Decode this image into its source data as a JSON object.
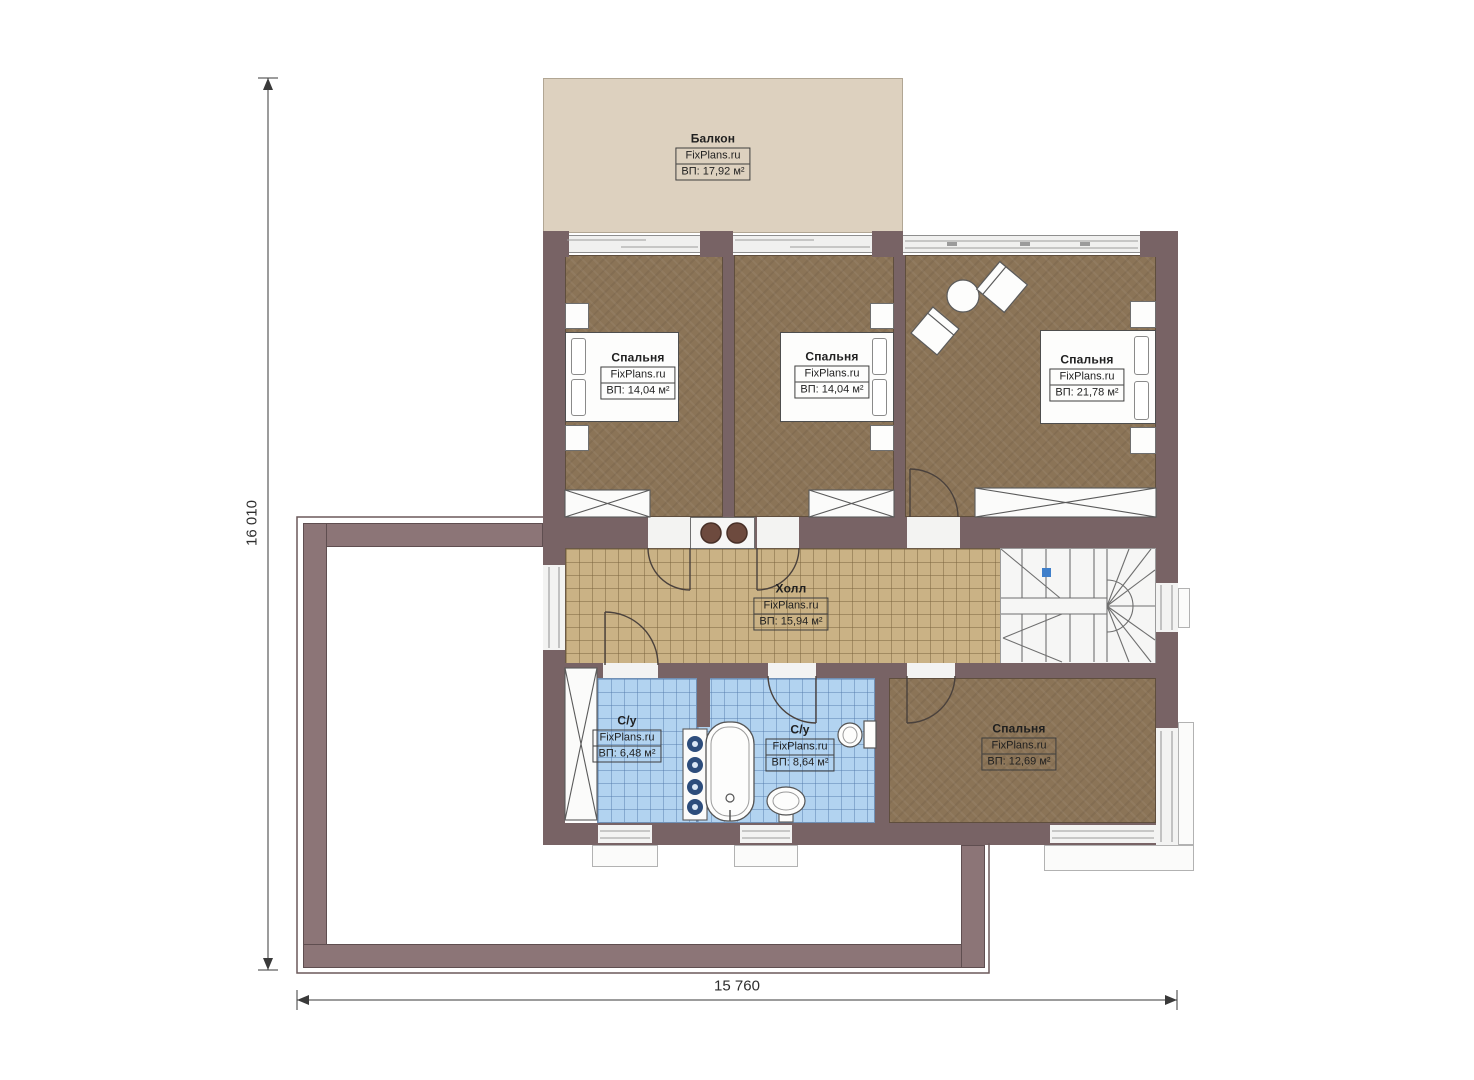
{
  "brand": "FixPlans.ru",
  "dimensions": {
    "height_label": "16 010",
    "width_label": "15 760"
  },
  "rooms": {
    "balcony": {
      "name": "Балкон",
      "brand": "FixPlans.ru",
      "area": "ВП: 17,92 м²"
    },
    "bedroom1": {
      "name": "Спальня",
      "brand": "FixPlans.ru",
      "area": "ВП: 14,04 м²"
    },
    "bedroom2": {
      "name": "Спальня",
      "brand": "FixPlans.ru",
      "area": "ВП: 14,04 м²"
    },
    "bedroom3": {
      "name": "Спальня",
      "brand": "FixPlans.ru",
      "area": "ВП: 21,78 м²"
    },
    "hall": {
      "name": "Холл",
      "brand": "FixPlans.ru",
      "area": "ВП: 15,94 м²"
    },
    "bath1": {
      "name": "С/у",
      "brand": "FixPlans.ru",
      "area": "ВП: 6,48 м²"
    },
    "bath2": {
      "name": "С/у",
      "brand": "FixPlans.ru",
      "area": "ВП: 8,64 м²"
    },
    "bedroom4": {
      "name": "Спальня",
      "brand": "FixPlans.ru",
      "area": "ВП: 12,69 м²"
    }
  },
  "colors": {
    "wall": "#786365",
    "roof_band": "#8c7577",
    "bedroom_floor": "#8b7457",
    "hall_floor": "#cab285",
    "bath_floor": "#b2d3f0",
    "balcony_floor": "#ddd1bf",
    "stair_marker": "#3f7fca"
  }
}
